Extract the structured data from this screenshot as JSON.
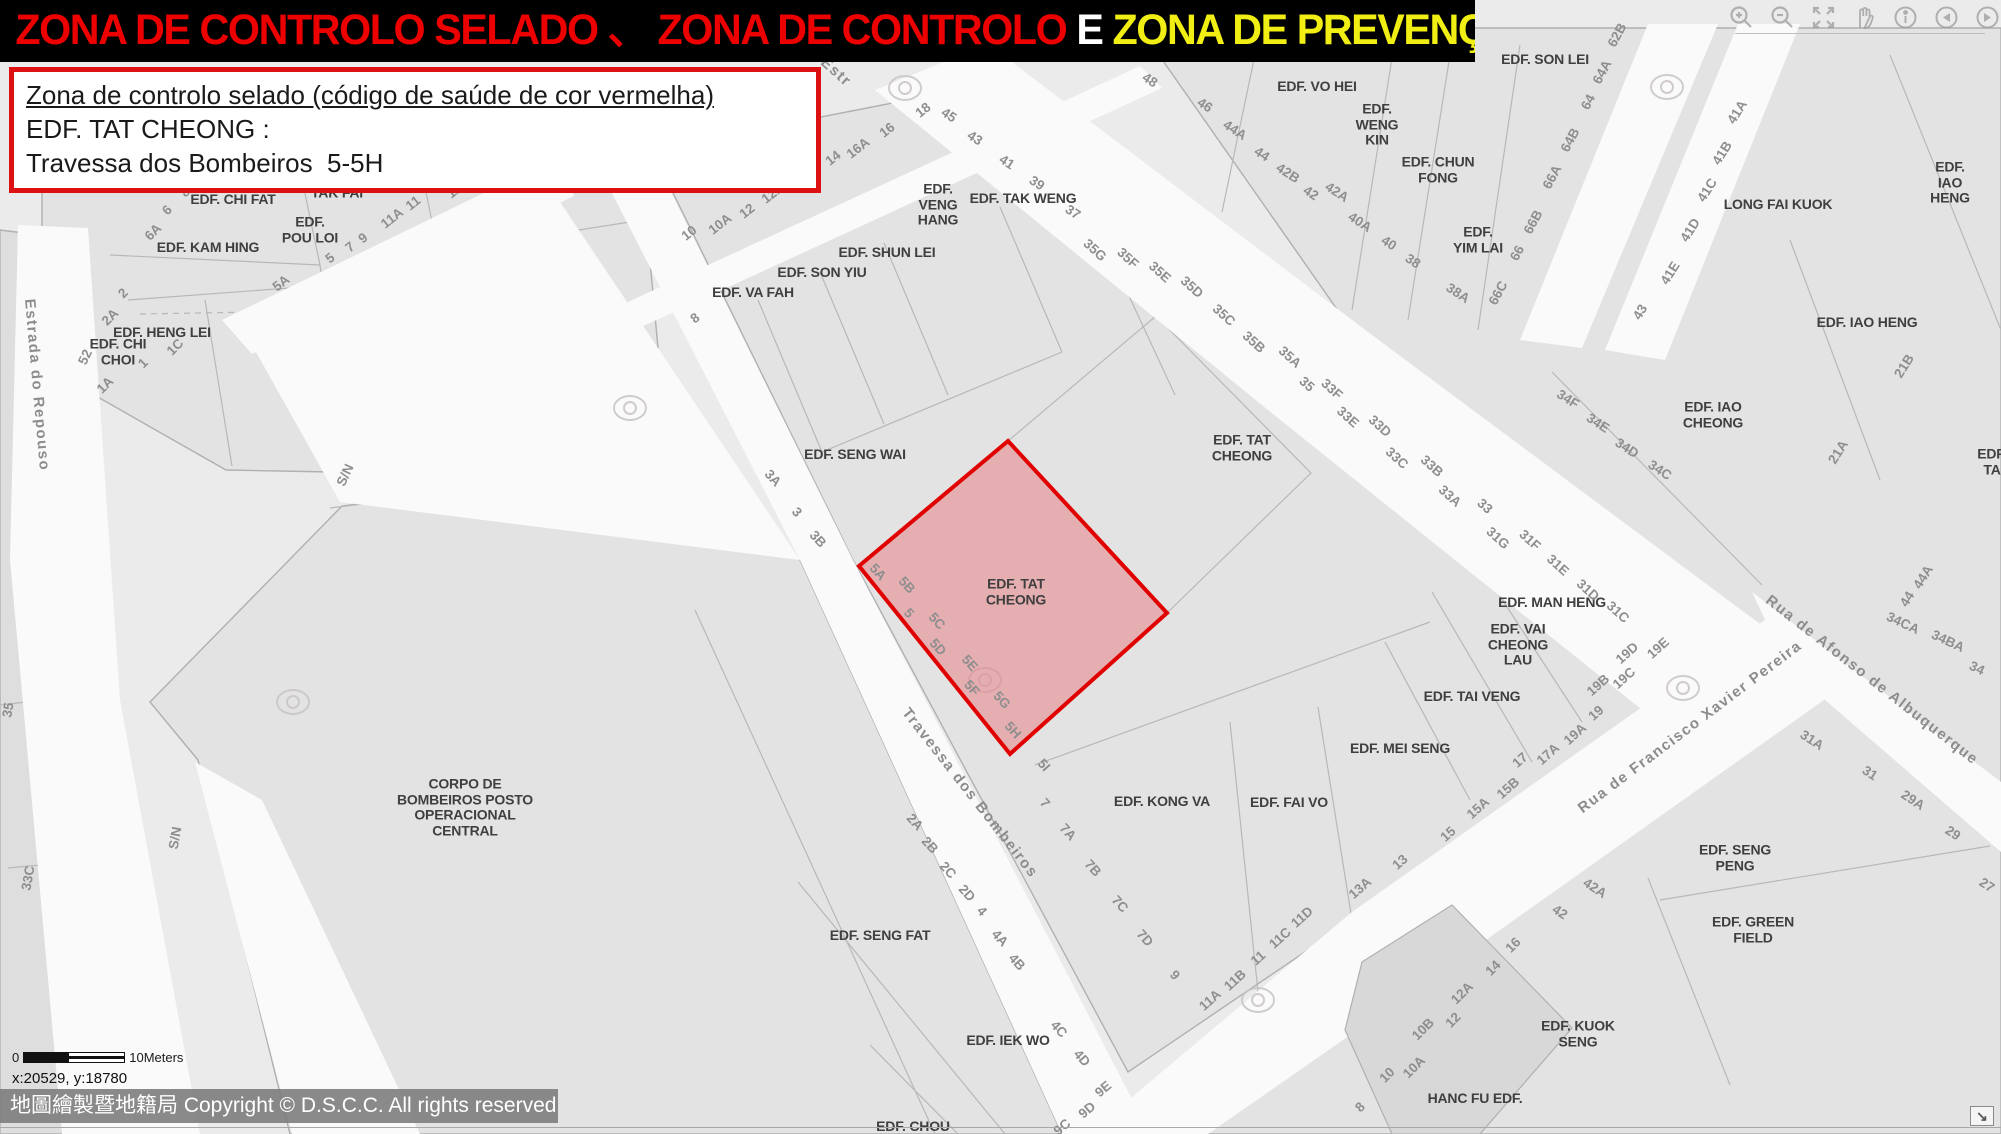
{
  "header": {
    "bar_bg": "#000000",
    "segments": [
      {
        "text": "ZONA DE CONTROLO SELADO 、 ZONA DE CONTROLO ",
        "color": "#ed0000"
      },
      {
        "text": "E ",
        "color": "#ffffff"
      },
      {
        "text": "ZONA DE PREVENÇÃO",
        "color": "#f0ee13"
      }
    ]
  },
  "info_box": {
    "border_color": "#dd1111",
    "line1": "Zona de controlo selado (código de saúde de cor vermelha)",
    "line2": "EDF. TAT CHEONG :",
    "line3": "Travessa dos Bombeiros  5-5H"
  },
  "toolbar": {
    "icons": [
      {
        "name": "zoom-in"
      },
      {
        "name": "zoom-out"
      },
      {
        "name": "full-extent"
      },
      {
        "name": "pan"
      },
      {
        "name": "identify"
      },
      {
        "name": "previous-view"
      },
      {
        "name": "next-view"
      }
    ]
  },
  "map": {
    "background": "#ebebeb",
    "street_color": "#fafafa",
    "parcel_color": "#e3e3e3",
    "line_color": "#b0b0b0",
    "sealed_zone": {
      "fill": "#e87a80",
      "border": "#e10000",
      "label": "EDF. TAT\nCHEONG"
    },
    "building_labels": [
      {
        "t": "EDF. CHI FAT",
        "x": 233,
        "y": 200
      },
      {
        "t": "EDF.\nTAK FAI",
        "x": 337,
        "y": 185
      },
      {
        "t": "EDF. KAM HING",
        "x": 208,
        "y": 248
      },
      {
        "t": "EDF.\nPOU LOI",
        "x": 310,
        "y": 230
      },
      {
        "t": "EDF. HENG LEI",
        "x": 162,
        "y": 333
      },
      {
        "t": "EDF. CHI\nCHOI",
        "x": 118,
        "y": 352
      },
      {
        "t": "EDF. VA FAH",
        "x": 753,
        "y": 293
      },
      {
        "t": "EDF. SON YIU",
        "x": 822,
        "y": 273
      },
      {
        "t": "EDF. SHUN LEI",
        "x": 887,
        "y": 253
      },
      {
        "t": "EDF.\nVENG\nHANG",
        "x": 938,
        "y": 205
      },
      {
        "t": "EDF. TAK WENG",
        "x": 1023,
        "y": 199
      },
      {
        "t": "EDF. SENG WAI",
        "x": 855,
        "y": 455
      },
      {
        "t": "EDF. TAT\nCHEONG",
        "x": 1242,
        "y": 448
      },
      {
        "t": "EDF. TAT\nCHEONG",
        "x": 1016,
        "y": 592
      },
      {
        "t": "EDF. SON LEI",
        "x": 1545,
        "y": 60
      },
      {
        "t": "EDF. VO HEI",
        "x": 1317,
        "y": 87
      },
      {
        "t": "EDF.\nWENG\nKIN",
        "x": 1377,
        "y": 125
      },
      {
        "t": "EDF. CHUN\nFONG",
        "x": 1438,
        "y": 170
      },
      {
        "t": "EDF.\nYIM LAI",
        "x": 1478,
        "y": 240
      },
      {
        "t": "LONG FAI KUOK",
        "x": 1778,
        "y": 205
      },
      {
        "t": "EDF. IAO HENG",
        "x": 1950,
        "y": 183
      },
      {
        "t": "EDF. IAO HENG",
        "x": 1867,
        "y": 323
      },
      {
        "t": "EDF. IAO\nCHEONG",
        "x": 1713,
        "y": 415
      },
      {
        "t": "EDF. TA",
        "x": 1992,
        "y": 462
      },
      {
        "t": "EDF. MAN HENG",
        "x": 1552,
        "y": 603
      },
      {
        "t": "EDF. VAI\nCHEONG\nLAU",
        "x": 1518,
        "y": 645
      },
      {
        "t": "EDF. TAI VENG",
        "x": 1472,
        "y": 697
      },
      {
        "t": "EDF. MEI SENG",
        "x": 1400,
        "y": 749
      },
      {
        "t": "EDF. KONG VA",
        "x": 1162,
        "y": 802
      },
      {
        "t": "EDF. FAI VO",
        "x": 1289,
        "y": 803
      },
      {
        "t": "EDF. SENG FAT",
        "x": 880,
        "y": 936
      },
      {
        "t": "EDF. IEK WO",
        "x": 1008,
        "y": 1041
      },
      {
        "t": "EDF. CHOU",
        "x": 913,
        "y": 1127
      },
      {
        "t": "CORPO DE\nBOMBEIROS POSTO\nOPERACIONAL\nCENTRAL",
        "x": 465,
        "y": 808
      },
      {
        "t": "EDF. SENG\nPENG",
        "x": 1735,
        "y": 858
      },
      {
        "t": "EDF. GREEN\nFIELD",
        "x": 1753,
        "y": 930
      },
      {
        "t": "EDF. KUOK\nSENG",
        "x": 1578,
        "y": 1034
      },
      {
        "t": "HANC FU EDF.",
        "x": 1475,
        "y": 1099
      }
    ],
    "number_labels": [
      {
        "t": "8",
        "x": 185,
        "y": 192,
        "r": -45
      },
      {
        "t": "6",
        "x": 167,
        "y": 210,
        "r": -45
      },
      {
        "t": "6A",
        "x": 153,
        "y": 232,
        "r": -45
      },
      {
        "t": "2",
        "x": 123,
        "y": 293,
        "r": -45
      },
      {
        "t": "2A",
        "x": 110,
        "y": 317,
        "r": -45
      },
      {
        "t": "52",
        "x": 85,
        "y": 357,
        "r": -65
      },
      {
        "t": "1",
        "x": 143,
        "y": 363,
        "r": -45
      },
      {
        "t": "1C",
        "x": 175,
        "y": 347,
        "r": -45
      },
      {
        "t": "1A",
        "x": 105,
        "y": 385,
        "r": -45
      },
      {
        "t": "5A",
        "x": 281,
        "y": 283,
        "r": -38
      },
      {
        "t": "5",
        "x": 330,
        "y": 258,
        "r": -38
      },
      {
        "t": "7",
        "x": 350,
        "y": 247,
        "r": -38
      },
      {
        "t": "9",
        "x": 363,
        "y": 238,
        "r": -38
      },
      {
        "t": "11A",
        "x": 392,
        "y": 218,
        "r": -38
      },
      {
        "t": "11",
        "x": 413,
        "y": 203,
        "r": -38
      },
      {
        "t": "11B",
        "x": 458,
        "y": 188,
        "r": -38
      },
      {
        "t": "10",
        "x": 689,
        "y": 233,
        "r": -38
      },
      {
        "t": "10A",
        "x": 720,
        "y": 224,
        "r": -38
      },
      {
        "t": "12",
        "x": 747,
        "y": 211,
        "r": -38
      },
      {
        "t": "12A",
        "x": 773,
        "y": 193,
        "r": -38
      },
      {
        "t": "14",
        "x": 833,
        "y": 158,
        "r": -38
      },
      {
        "t": "16A",
        "x": 858,
        "y": 148,
        "r": -38
      },
      {
        "t": "16",
        "x": 887,
        "y": 130,
        "r": -38
      },
      {
        "t": "18",
        "x": 923,
        "y": 110,
        "r": -38
      },
      {
        "t": "8",
        "x": 695,
        "y": 318,
        "r": -38
      },
      {
        "t": "45",
        "x": 949,
        "y": 115,
        "r": 33
      },
      {
        "t": "43",
        "x": 975,
        "y": 138,
        "r": 33
      },
      {
        "t": "41",
        "x": 1007,
        "y": 162,
        "r": 33
      },
      {
        "t": "39",
        "x": 1037,
        "y": 183,
        "r": 33
      },
      {
        "t": "37",
        "x": 1073,
        "y": 212,
        "r": 33
      },
      {
        "t": "35G",
        "x": 1095,
        "y": 250,
        "r": 42
      },
      {
        "t": "35F",
        "x": 1128,
        "y": 258,
        "r": 42
      },
      {
        "t": "35E",
        "x": 1160,
        "y": 272,
        "r": 42
      },
      {
        "t": "35D",
        "x": 1192,
        "y": 287,
        "r": 42
      },
      {
        "t": "35C",
        "x": 1224,
        "y": 315,
        "r": 42
      },
      {
        "t": "35B",
        "x": 1254,
        "y": 342,
        "r": 42
      },
      {
        "t": "35A",
        "x": 1290,
        "y": 357,
        "r": 42
      },
      {
        "t": "35",
        "x": 1307,
        "y": 384,
        "r": 42
      },
      {
        "t": "33F",
        "x": 1332,
        "y": 389,
        "r": 42
      },
      {
        "t": "33E",
        "x": 1348,
        "y": 417,
        "r": 42
      },
      {
        "t": "33D",
        "x": 1380,
        "y": 426,
        "r": 42
      },
      {
        "t": "33C",
        "x": 1397,
        "y": 458,
        "r": 42
      },
      {
        "t": "33B",
        "x": 1432,
        "y": 466,
        "r": 42
      },
      {
        "t": "33A",
        "x": 1450,
        "y": 496,
        "r": 42
      },
      {
        "t": "33",
        "x": 1485,
        "y": 506,
        "r": 42
      },
      {
        "t": "31G",
        "x": 1498,
        "y": 538,
        "r": 42
      },
      {
        "t": "31F",
        "x": 1530,
        "y": 540,
        "r": 42
      },
      {
        "t": "31E",
        "x": 1558,
        "y": 565,
        "r": 42
      },
      {
        "t": "31D",
        "x": 1588,
        "y": 590,
        "r": 42
      },
      {
        "t": "31C",
        "x": 1618,
        "y": 612,
        "r": 42
      },
      {
        "t": "48",
        "x": 1150,
        "y": 80,
        "r": 33
      },
      {
        "t": "46",
        "x": 1205,
        "y": 105,
        "r": 33
      },
      {
        "t": "44A",
        "x": 1235,
        "y": 130,
        "r": 33
      },
      {
        "t": "44",
        "x": 1262,
        "y": 154,
        "r": 33
      },
      {
        "t": "42B",
        "x": 1288,
        "y": 173,
        "r": 33
      },
      {
        "t": "42",
        "x": 1311,
        "y": 193,
        "r": 33
      },
      {
        "t": "42A",
        "x": 1337,
        "y": 192,
        "r": 33
      },
      {
        "t": "40A",
        "x": 1360,
        "y": 222,
        "r": 33
      },
      {
        "t": "40",
        "x": 1389,
        "y": 243,
        "r": 33
      },
      {
        "t": "38",
        "x": 1413,
        "y": 261,
        "r": 33
      },
      {
        "t": "38A",
        "x": 1458,
        "y": 293,
        "r": 33
      },
      {
        "t": "62B",
        "x": 1617,
        "y": 35,
        "r": -62
      },
      {
        "t": "64A",
        "x": 1602,
        "y": 72,
        "r": -62
      },
      {
        "t": "64",
        "x": 1588,
        "y": 102,
        "r": -62
      },
      {
        "t": "64B",
        "x": 1570,
        "y": 140,
        "r": -62
      },
      {
        "t": "66A",
        "x": 1552,
        "y": 177,
        "r": -62
      },
      {
        "t": "66B",
        "x": 1533,
        "y": 222,
        "r": -62
      },
      {
        "t": "66",
        "x": 1517,
        "y": 253,
        "r": -62
      },
      {
        "t": "66C",
        "x": 1498,
        "y": 293,
        "r": -62
      },
      {
        "t": "41A",
        "x": 1737,
        "y": 112,
        "r": -58
      },
      {
        "t": "41B",
        "x": 1722,
        "y": 153,
        "r": -58
      },
      {
        "t": "41C",
        "x": 1707,
        "y": 190,
        "r": -58
      },
      {
        "t": "41D",
        "x": 1690,
        "y": 230,
        "r": -58
      },
      {
        "t": "41E",
        "x": 1670,
        "y": 273,
        "r": -58
      },
      {
        "t": "43",
        "x": 1640,
        "y": 312,
        "r": -58
      },
      {
        "t": "34F",
        "x": 1568,
        "y": 399,
        "r": 33
      },
      {
        "t": "34E",
        "x": 1598,
        "y": 423,
        "r": 33
      },
      {
        "t": "34D",
        "x": 1627,
        "y": 448,
        "r": 33
      },
      {
        "t": "34C",
        "x": 1660,
        "y": 470,
        "r": 33
      },
      {
        "t": "21B",
        "x": 1904,
        "y": 366,
        "r": -58
      },
      {
        "t": "21A",
        "x": 1838,
        "y": 452,
        "r": -58
      },
      {
        "t": "44A",
        "x": 1923,
        "y": 577,
        "r": -58
      },
      {
        "t": "44",
        "x": 1907,
        "y": 599,
        "r": -58
      },
      {
        "t": "34CA",
        "x": 1903,
        "y": 623,
        "r": 25
      },
      {
        "t": "34BA",
        "x": 1948,
        "y": 641,
        "r": 25
      },
      {
        "t": "34",
        "x": 1977,
        "y": 668,
        "r": 25
      },
      {
        "t": "3A",
        "x": 773,
        "y": 478,
        "r": 48
      },
      {
        "t": "3",
        "x": 797,
        "y": 512,
        "r": 48
      },
      {
        "t": "3B",
        "x": 818,
        "y": 539,
        "r": 48
      },
      {
        "t": "5A",
        "x": 878,
        "y": 572,
        "r": 48
      },
      {
        "t": "5B",
        "x": 907,
        "y": 585,
        "r": 48
      },
      {
        "t": "5",
        "x": 909,
        "y": 613,
        "r": 48
      },
      {
        "t": "5C",
        "x": 937,
        "y": 621,
        "r": 48
      },
      {
        "t": "5D",
        "x": 938,
        "y": 647,
        "r": 48
      },
      {
        "t": "5E",
        "x": 970,
        "y": 663,
        "r": 48
      },
      {
        "t": "5F",
        "x": 972,
        "y": 688,
        "r": 48
      },
      {
        "t": "5G",
        "x": 1002,
        "y": 700,
        "r": 48
      },
      {
        "t": "5H",
        "x": 1013,
        "y": 730,
        "r": 48
      },
      {
        "t": "5I",
        "x": 1044,
        "y": 765,
        "r": 48
      },
      {
        "t": "7",
        "x": 1045,
        "y": 803,
        "r": 48
      },
      {
        "t": "7A",
        "x": 1068,
        "y": 832,
        "r": 48
      },
      {
        "t": "7B",
        "x": 1093,
        "y": 868,
        "r": 48
      },
      {
        "t": "7C",
        "x": 1120,
        "y": 904,
        "r": 48
      },
      {
        "t": "7D",
        "x": 1145,
        "y": 938,
        "r": 48
      },
      {
        "t": "9",
        "x": 1175,
        "y": 975,
        "r": 48
      },
      {
        "t": "2A",
        "x": 915,
        "y": 822,
        "r": 48
      },
      {
        "t": "2B",
        "x": 930,
        "y": 845,
        "r": 48
      },
      {
        "t": "2C",
        "x": 948,
        "y": 870,
        "r": 48
      },
      {
        "t": "2D",
        "x": 967,
        "y": 893,
        "r": 48
      },
      {
        "t": "4",
        "x": 982,
        "y": 911,
        "r": 48
      },
      {
        "t": "4A",
        "x": 1000,
        "y": 938,
        "r": 48
      },
      {
        "t": "4B",
        "x": 1017,
        "y": 962,
        "r": 48
      },
      {
        "t": "4C",
        "x": 1059,
        "y": 1029,
        "r": 48
      },
      {
        "t": "4D",
        "x": 1082,
        "y": 1058,
        "r": 48
      },
      {
        "t": "9E",
        "x": 1103,
        "y": 1089,
        "r": -40
      },
      {
        "t": "9D",
        "x": 1087,
        "y": 1110,
        "r": -40
      },
      {
        "t": "9C",
        "x": 1062,
        "y": 1127,
        "r": -40
      },
      {
        "t": "11A",
        "x": 1210,
        "y": 1000,
        "r": -42
      },
      {
        "t": "11B",
        "x": 1235,
        "y": 980,
        "r": -42
      },
      {
        "t": "11",
        "x": 1258,
        "y": 958,
        "r": -42
      },
      {
        "t": "11C",
        "x": 1280,
        "y": 938,
        "r": -42
      },
      {
        "t": "11D",
        "x": 1302,
        "y": 917,
        "r": -42
      },
      {
        "t": "13A",
        "x": 1360,
        "y": 888,
        "r": -42
      },
      {
        "t": "13",
        "x": 1400,
        "y": 862,
        "r": -42
      },
      {
        "t": "15",
        "x": 1448,
        "y": 834,
        "r": -42
      },
      {
        "t": "15A",
        "x": 1478,
        "y": 808,
        "r": -42
      },
      {
        "t": "15B",
        "x": 1508,
        "y": 788,
        "r": -42
      },
      {
        "t": "17",
        "x": 1520,
        "y": 760,
        "r": -42
      },
      {
        "t": "17A",
        "x": 1548,
        "y": 754,
        "r": -42
      },
      {
        "t": "19A",
        "x": 1575,
        "y": 734,
        "r": -42
      },
      {
        "t": "19",
        "x": 1596,
        "y": 713,
        "r": -42
      },
      {
        "t": "19B",
        "x": 1598,
        "y": 685,
        "r": -42
      },
      {
        "t": "19C",
        "x": 1624,
        "y": 678,
        "r": -42
      },
      {
        "t": "19D",
        "x": 1627,
        "y": 653,
        "r": -42
      },
      {
        "t": "19E",
        "x": 1658,
        "y": 648,
        "r": -42
      },
      {
        "t": "31A",
        "x": 1812,
        "y": 740,
        "r": 33
      },
      {
        "t": "31",
        "x": 1870,
        "y": 773,
        "r": 33
      },
      {
        "t": "29A",
        "x": 1913,
        "y": 800,
        "r": 33
      },
      {
        "t": "29",
        "x": 1953,
        "y": 833,
        "r": 33
      },
      {
        "t": "27",
        "x": 1987,
        "y": 885,
        "r": 33
      },
      {
        "t": "42A",
        "x": 1595,
        "y": 888,
        "r": 33
      },
      {
        "t": "42",
        "x": 1560,
        "y": 912,
        "r": 33
      },
      {
        "t": "16",
        "x": 1513,
        "y": 945,
        "r": -45
      },
      {
        "t": "14",
        "x": 1493,
        "y": 968,
        "r": -45
      },
      {
        "t": "12A",
        "x": 1462,
        "y": 993,
        "r": -45
      },
      {
        "t": "12",
        "x": 1453,
        "y": 1020,
        "r": -45
      },
      {
        "t": "10B",
        "x": 1423,
        "y": 1029,
        "r": -45
      },
      {
        "t": "10A",
        "x": 1414,
        "y": 1067,
        "r": -45
      },
      {
        "t": "10",
        "x": 1387,
        "y": 1075,
        "r": -45
      },
      {
        "t": "8",
        "x": 1360,
        "y": 1107,
        "r": -45
      },
      {
        "t": "S/N",
        "x": 345,
        "y": 475,
        "r": -65
      },
      {
        "t": "S/N",
        "x": 175,
        "y": 838,
        "r": -80
      },
      {
        "t": "35",
        "x": 8,
        "y": 710,
        "r": -80
      },
      {
        "t": "33C",
        "x": 28,
        "y": 878,
        "r": -80
      }
    ],
    "street_labels": [
      {
        "t": "Estrada do Repouso",
        "x": 37,
        "y": 385,
        "r": 85
      },
      {
        "t": "Travessa dos Bombeiros",
        "x": 970,
        "y": 793,
        "r": 52
      },
      {
        "t": "Rua de Francisco Xavier Pereira",
        "x": 1690,
        "y": 727,
        "r": -37
      },
      {
        "t": "Rua de Afonso de Albuquerque",
        "x": 1872,
        "y": 680,
        "r": 38
      },
      {
        "t": "Estr",
        "x": 836,
        "y": 72,
        "r": 42
      }
    ]
  },
  "scale_bar": {
    "zero": "0",
    "label": "10Meters"
  },
  "coordinates": "x:20529, y:18780",
  "copyright": "地圖繪製暨地籍局 Copyright © D.S.C.C. All rights reserved",
  "overview_toggle": {
    "glyph": "↘"
  }
}
